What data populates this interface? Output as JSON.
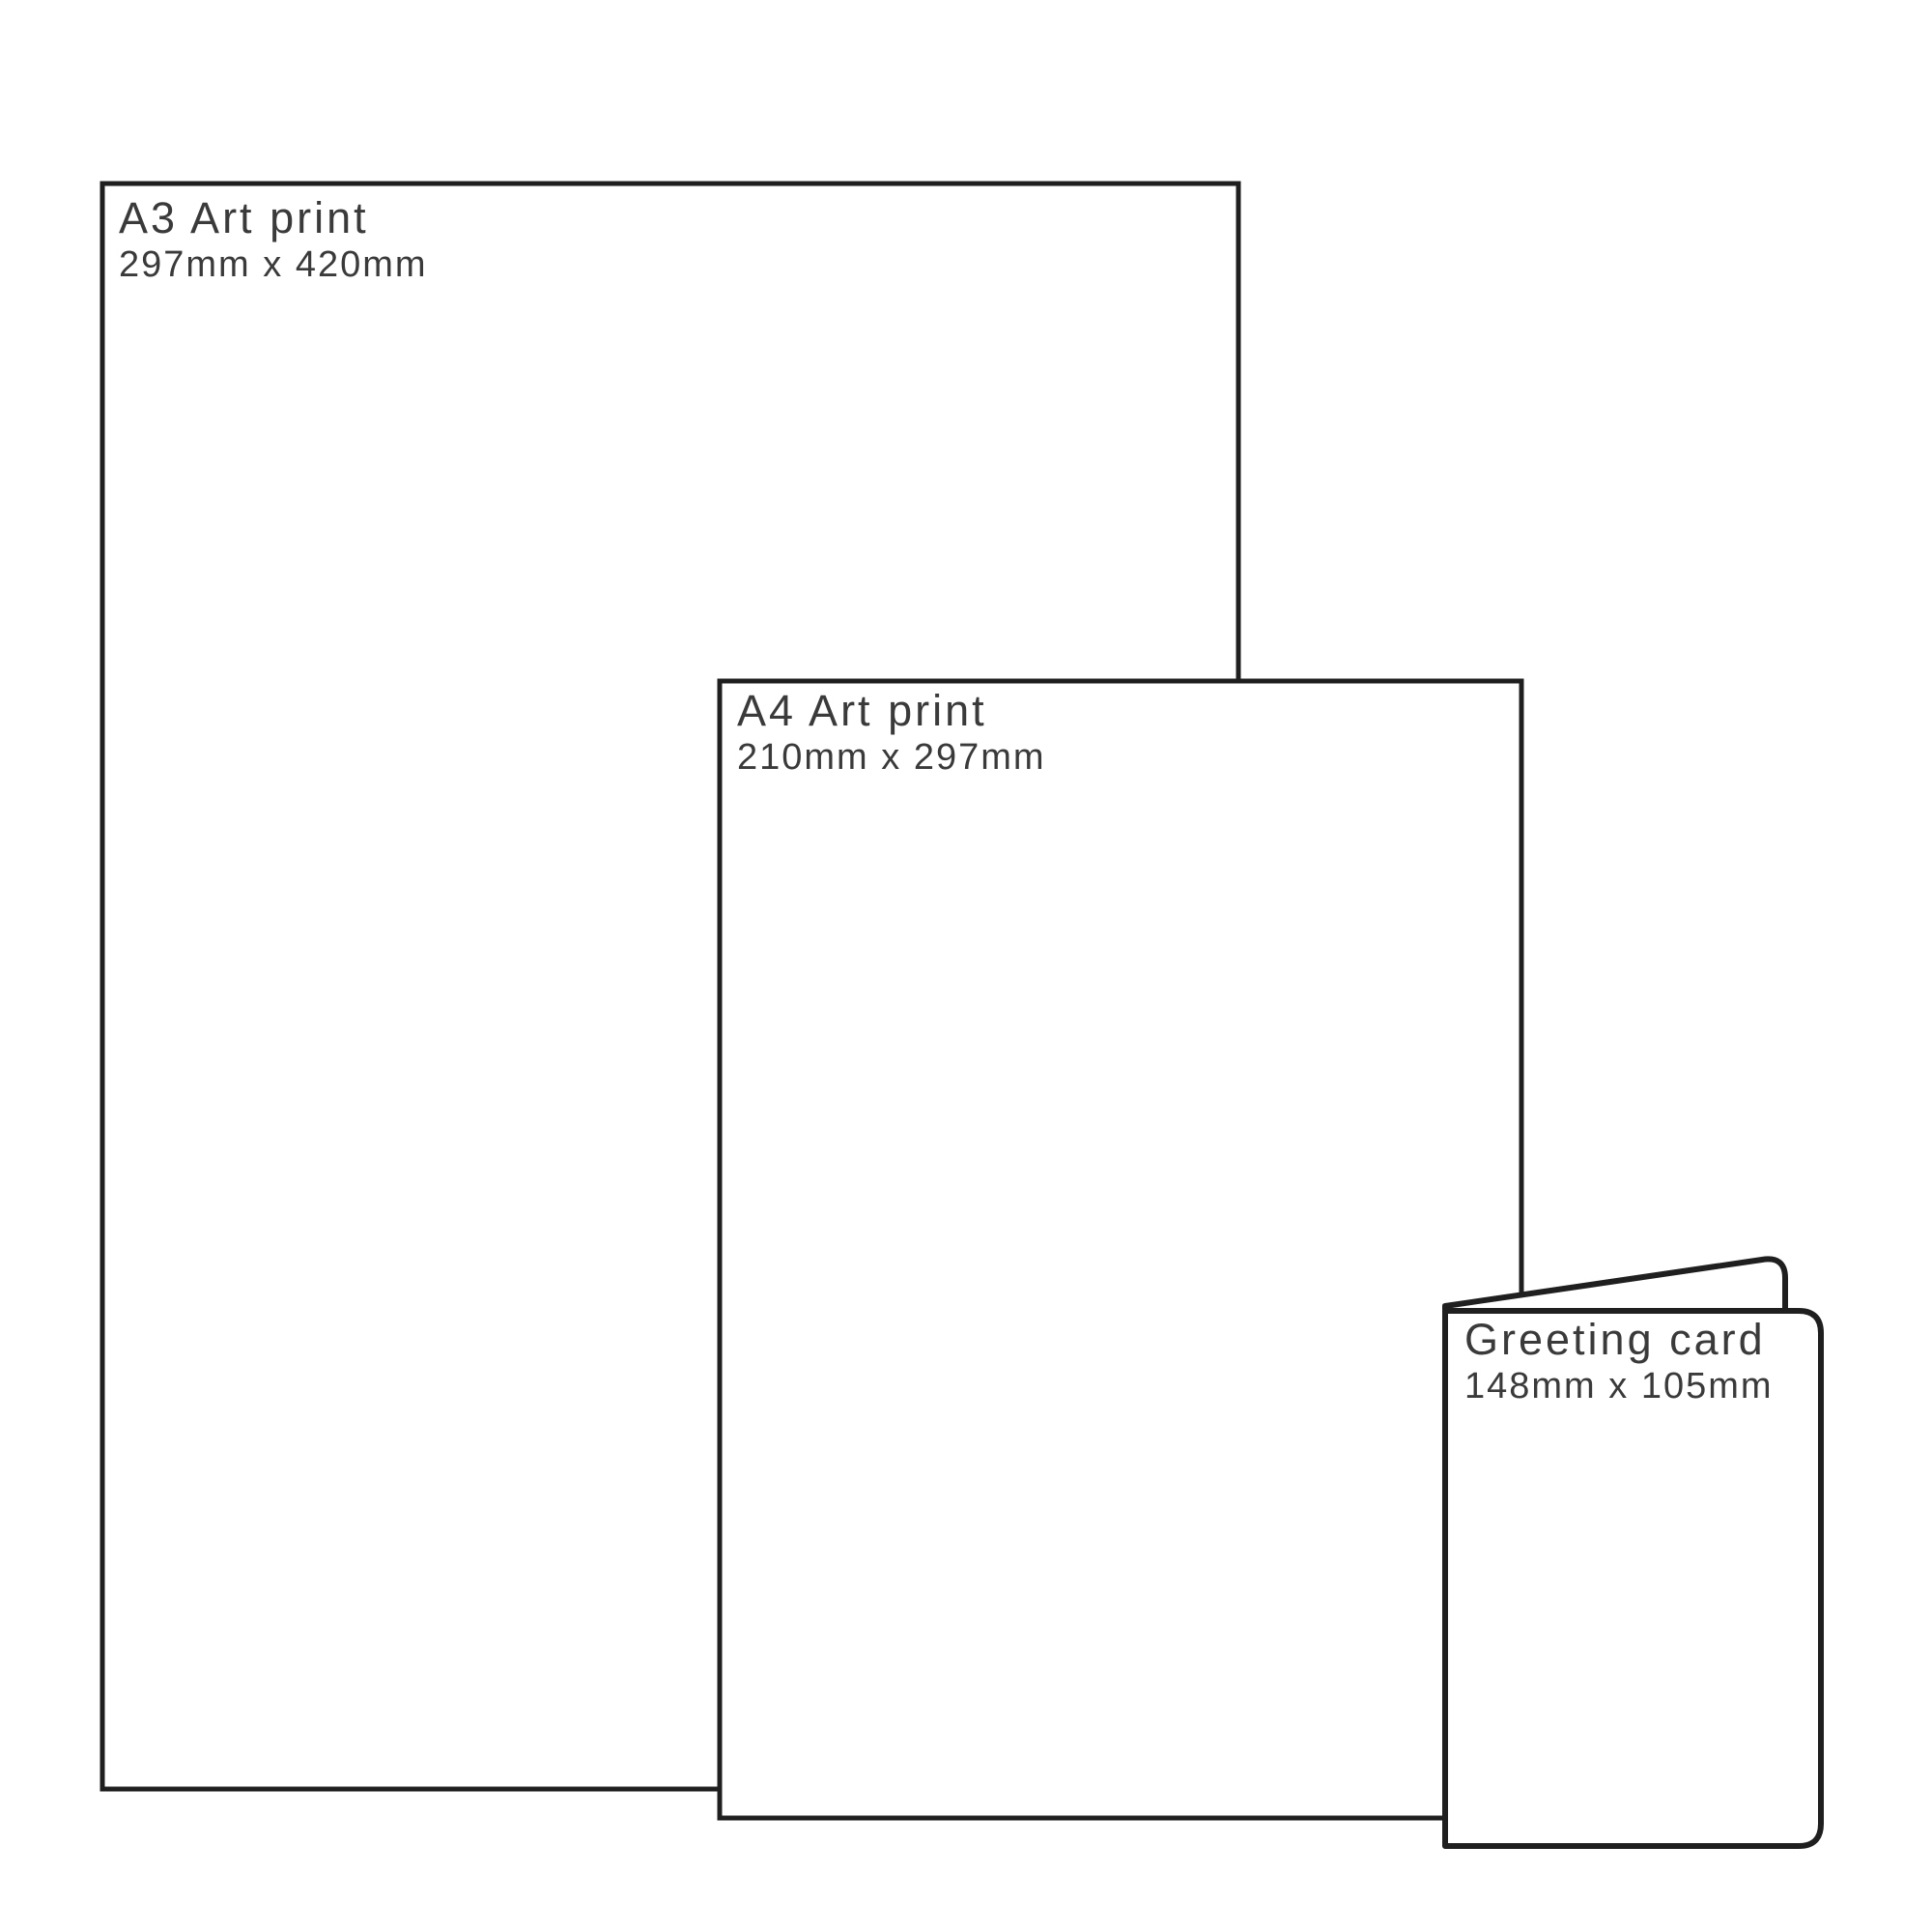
{
  "colors": {
    "line": "#1f1f1f",
    "text": "#3a3a3a",
    "background": "#ffffff"
  },
  "items": [
    {
      "id": "a3-art-print",
      "label": "A3 Art print",
      "dimensions": "297mm x 420mm"
    },
    {
      "id": "a4-art-print",
      "label": "A4 Art print",
      "dimensions": "210mm x 297mm"
    },
    {
      "id": "greeting-card",
      "label": "Greeting card",
      "dimensions": "148mm x 105mm"
    }
  ]
}
